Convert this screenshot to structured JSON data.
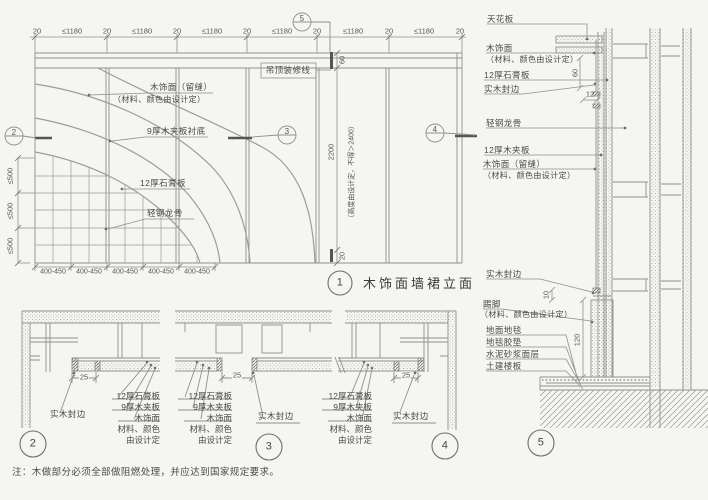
{
  "colors": {
    "line": "#8f8f8f",
    "dark_line": "#555555",
    "text": "#4a4a4a",
    "bg": "#f5f5f2"
  },
  "elevation": {
    "title_num": "1",
    "title": "木饰面墙裙立面",
    "dims": {
      "d20": "20",
      "d1180": "≤1180",
      "d500": "≤500",
      "d400_450": "400-450",
      "d60": "60",
      "d2200": "2200",
      "d20b": "20",
      "height_note": "（高度由设计定，不得＞2400）"
    },
    "labels": {
      "ceiling_trim": "吊顶装修线",
      "veneer": "木饰面（留缝）",
      "spec_note": "（材料、颜色由设计定）",
      "plywood": "9厚木夹板衬底",
      "gypsum": "12厚石膏板",
      "keel": "轻钢龙骨"
    },
    "markers": {
      "left": "2",
      "mid": "3",
      "right": "4",
      "top": "5"
    }
  },
  "detail5": {
    "num": "5",
    "labels": {
      "ceiling": "天花板",
      "veneer": "木饰面",
      "spec_note": "（材料、颜色由设计定）",
      "gypsum": "12厚石膏板",
      "wood_edge": "实木封边",
      "keel": "轻钢龙骨",
      "plywood": "12厚木夹板",
      "veneer_seam": "木饰面（留缝）",
      "skirting": "踢脚",
      "carpet": "地面地毯",
      "underlay": "地毯胶垫",
      "mortar": "水泥砂浆面层",
      "slab": "土建楼板"
    },
    "dims": {
      "d60": "60",
      "d12": "12",
      "d10": "10",
      "d120": "120"
    }
  },
  "details_bottom": {
    "stack": [
      "12厚石膏板",
      "9厚木夹板",
      "木饰面",
      "材料、颜色",
      "由设计定"
    ],
    "wood_edge": "实木封边",
    "d25": "25",
    "nums": {
      "n2": "2",
      "n3": "3",
      "n4": "4"
    }
  },
  "note": "注：木做部分必须全部做阻燃处理，并应达到国家规定要求。"
}
